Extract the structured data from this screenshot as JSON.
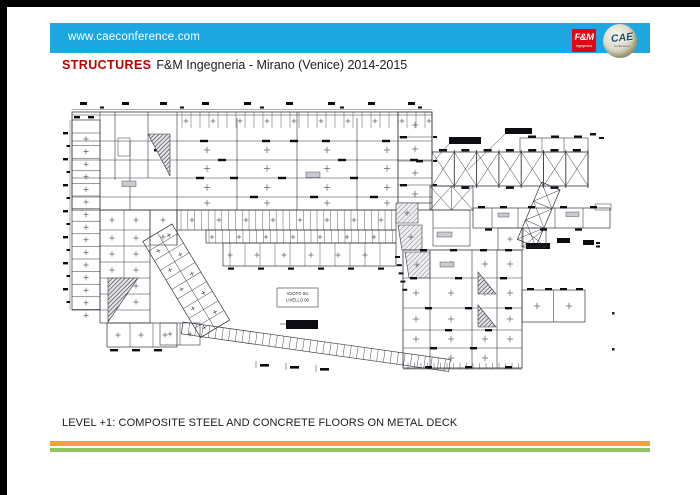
{
  "frame": {
    "border_color": "#000000",
    "slide_background": "#FFFFFF"
  },
  "header": {
    "bar_color": "#1CA7E0",
    "url_text": "www.caeconference.com",
    "url_color": "#FFFFFF",
    "fm_logo": {
      "title": "F&M",
      "subtitle": "ingegneria",
      "bg_color": "#E30613",
      "text_color": "#FFFFFF"
    },
    "cae_logo": {
      "title": "CAE",
      "subtitle": "Conference",
      "text_color": "#274A68"
    }
  },
  "title": {
    "keyword": "STRUCTURES",
    "keyword_color": "#C00000",
    "text": "F&M Ingegneria - Mirano (Venice) 2014-2015",
    "text_color": "#1C1C1C"
  },
  "drawing": {
    "void_label_line1": "VUOTO SU",
    "void_label_line2": "LIVELLO 00",
    "line_color": "#34343E"
  },
  "caption": {
    "text": "LEVEL +1: COMPOSITE STEEL AND CONCRETE FLOORS ON METAL DECK",
    "color": "#1C1C1C"
  },
  "footer": {
    "stripe_orange": "#F2A23C",
    "stripe_green": "#8FC561"
  }
}
